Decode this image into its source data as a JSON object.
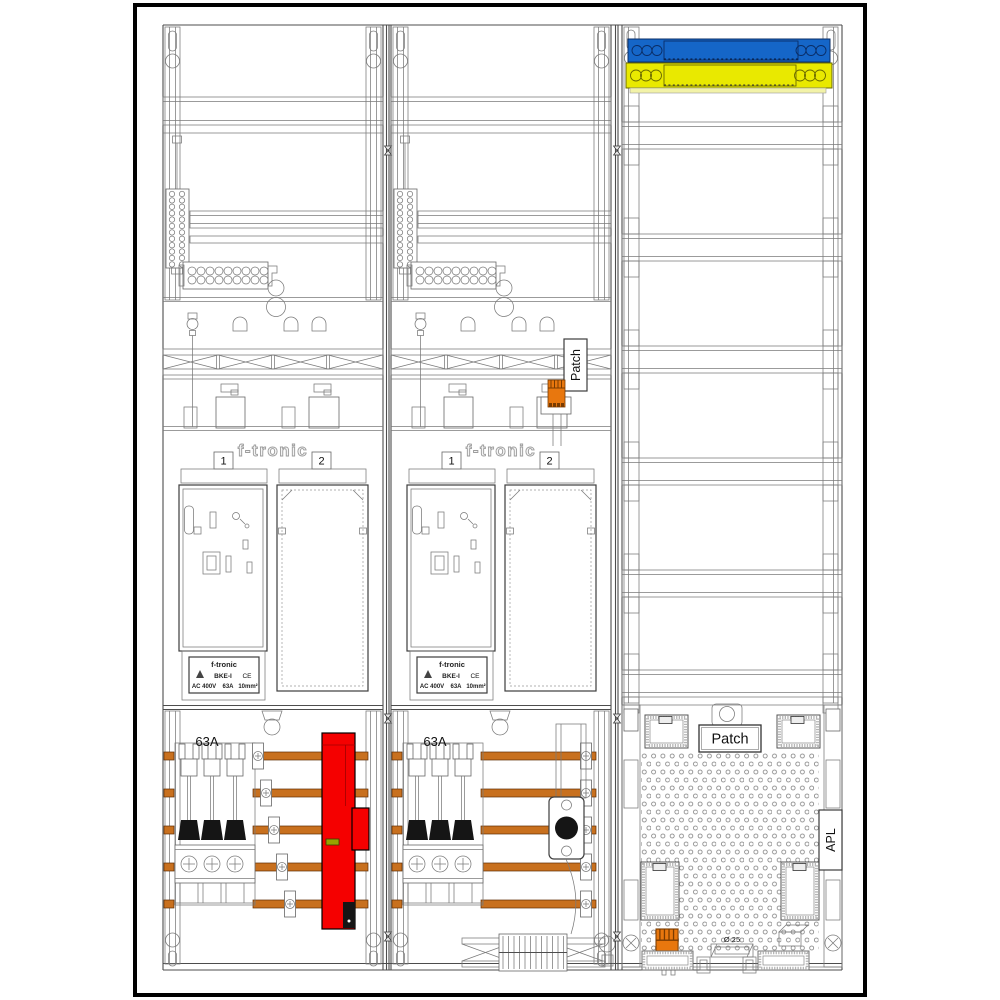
{
  "colors": {
    "busbar": "#C8701E",
    "neutral_bar": "#1566C8",
    "pe_bar": "#E9E900",
    "pe_bar_lip": "#F2F2A8",
    "main_switch": "#F50000",
    "switch_indicator": "#97A300",
    "cable_gland": "#E8770E"
  },
  "meter_fields": [
    {
      "brand": "f-tronic",
      "slot1": "1",
      "slot2": "2",
      "fuse_rating": "63A",
      "rating_plate": {
        "brand": "f-tronic",
        "type": "BKE-I",
        "ce": "CE",
        "voltage": "AC 400V",
        "current": "63A",
        "wire_size": "10mm²"
      }
    },
    {
      "brand": "f-tronic",
      "slot1": "1",
      "slot2": "2",
      "fuse_rating": "63A",
      "rating_plate": {
        "brand": "f-tronic",
        "type": "BKE-I",
        "ce": "CE",
        "voltage": "AC 400V",
        "current": "63A",
        "wire_size": "10mm²"
      }
    }
  ],
  "labels": {
    "patch_riser": "Patch"
  },
  "distribution_field": {
    "patch_label": "Patch",
    "apl_label": "APL",
    "conduit_diameter": "Ø 25"
  }
}
